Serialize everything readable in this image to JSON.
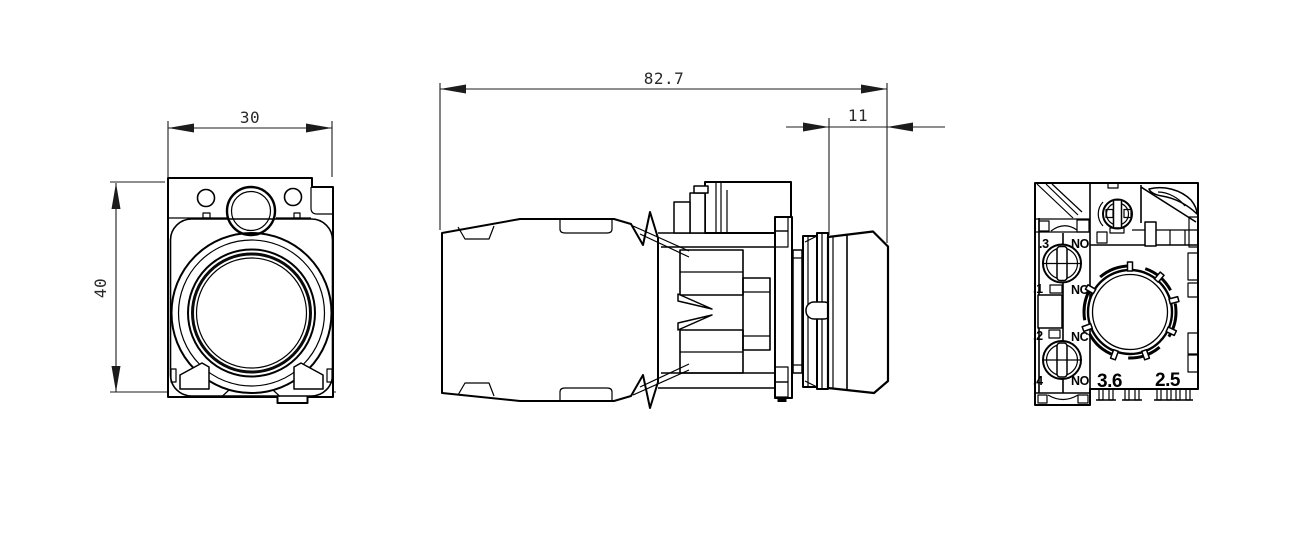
{
  "drawing": {
    "kind": "dimensioned-engineering-drawing",
    "subject": "pushbutton with contact block, three orthographic views",
    "colors": {
      "line": "#000000",
      "background": "#ffffff"
    },
    "views": {
      "front": {
        "width_dim": "30",
        "height_dim": "40"
      },
      "side": {
        "overall_length_dim": "82.7",
        "button_depth_dim": "11"
      },
      "rear": {
        "terminals": [
          {
            "id": ".3",
            "contact": "NO"
          },
          {
            "id": ".1",
            "contact": "NC"
          },
          {
            "id": ".2",
            "contact": "NC"
          },
          {
            "id": ".4",
            "contact": "NO"
          }
        ],
        "mold_markings": [
          "3.6",
          "2.5"
        ]
      }
    }
  }
}
